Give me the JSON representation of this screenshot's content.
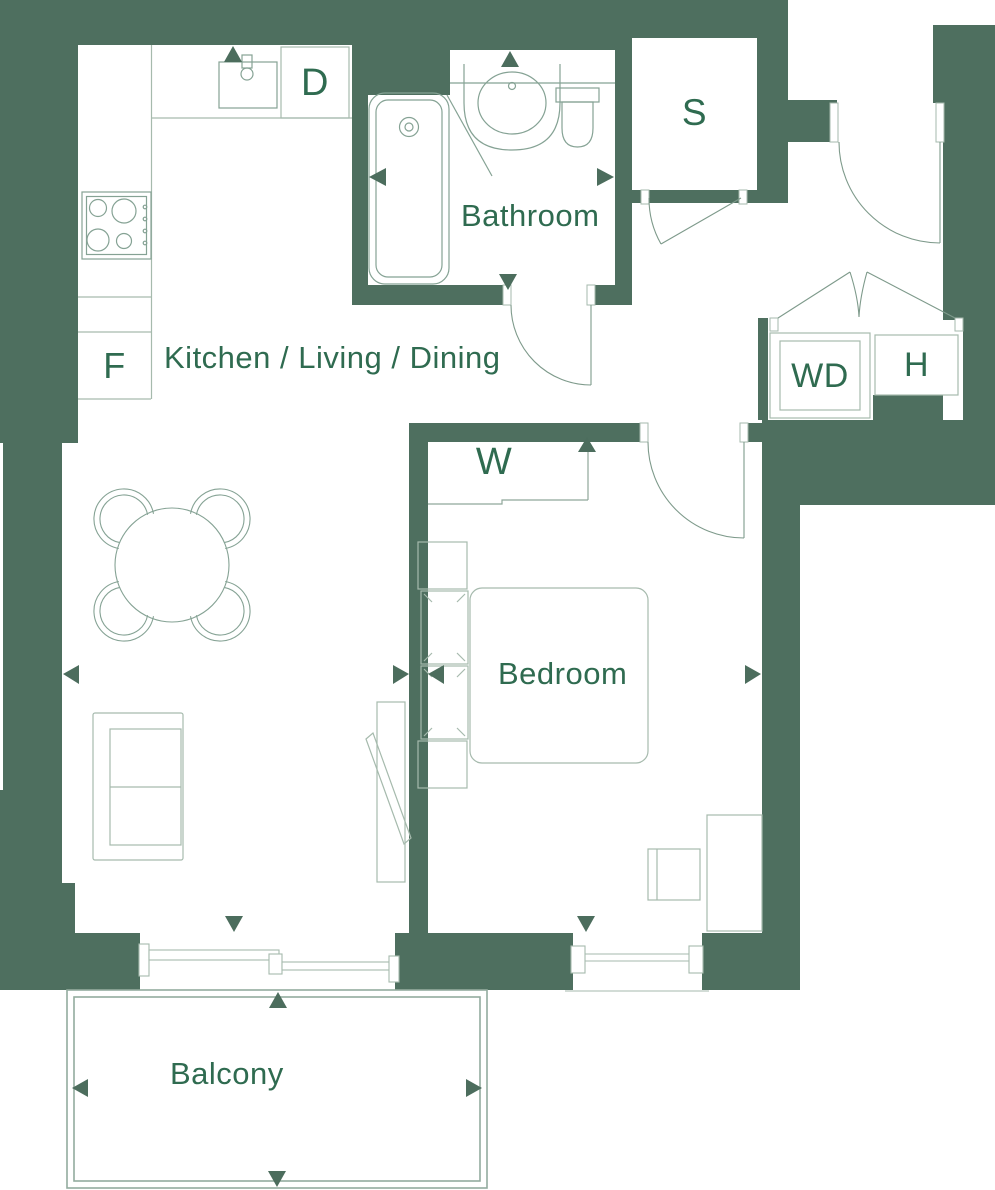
{
  "rooms": {
    "kitchen_living_dining": "Kitchen / Living / Dining",
    "bathroom": "Bathroom",
    "bedroom": "Bedroom",
    "balcony": "Balcony"
  },
  "unit_labels": {
    "dishwasher": "D",
    "fridge": "F",
    "store": "S",
    "washer_dryer": "WD",
    "utility": "H",
    "wardrobe": "W"
  },
  "colors": {
    "wall": "#4E6F5F",
    "label_text": "#2F6B50",
    "fixture_line": "#85A294",
    "furniture_line": "#A6BAAD",
    "door_line": "#7E9A8B",
    "balcony_line": "#93AB9E",
    "marker_arrow": "#4C6D5D",
    "background": "#FFFFFF"
  }
}
